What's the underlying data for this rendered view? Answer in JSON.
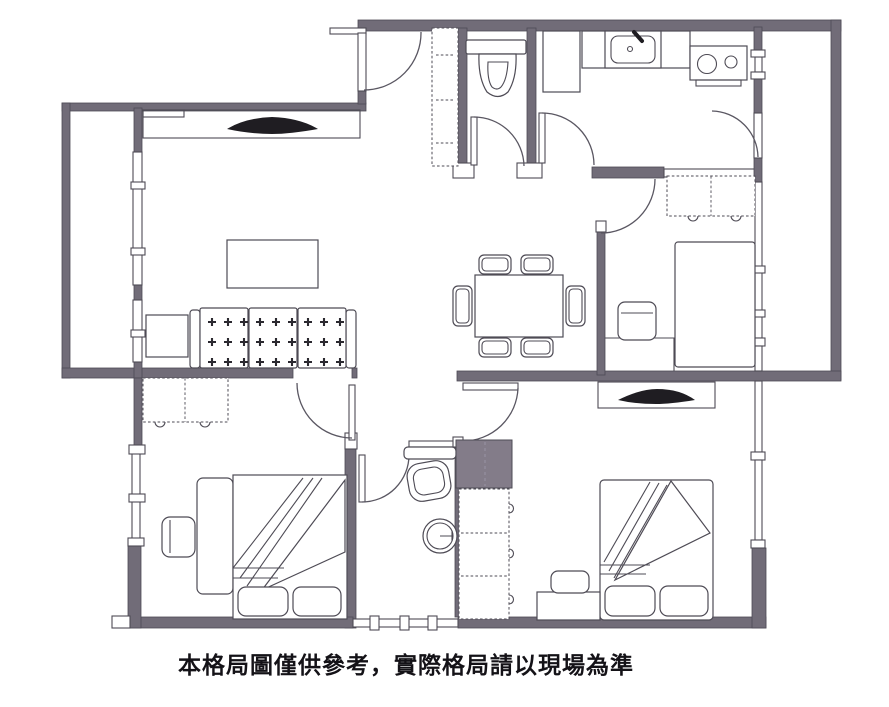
{
  "caption": {
    "text": "本格局圖僅供參考，實際格局請以現場為準"
  },
  "colors": {
    "wall": "#716c78",
    "outline": "#4e4b55",
    "cabinet_fill": "#837c89",
    "tv_black": "#1f1d22",
    "paper": "#ffffff",
    "caption_color": "#141217"
  },
  "visible_elements": "floor plan with walls, window bands, door swing arcs, sofa, two TVs, coffee table, dining table with six chairs, two toilets, round basin, kitchen sink, two-burner stove, fridge cabinet, three beds with pillows and folded blankets, dashed wardrobes, shoe cabinet, dark utility cabinet, bench, nightstands, two balconies"
}
